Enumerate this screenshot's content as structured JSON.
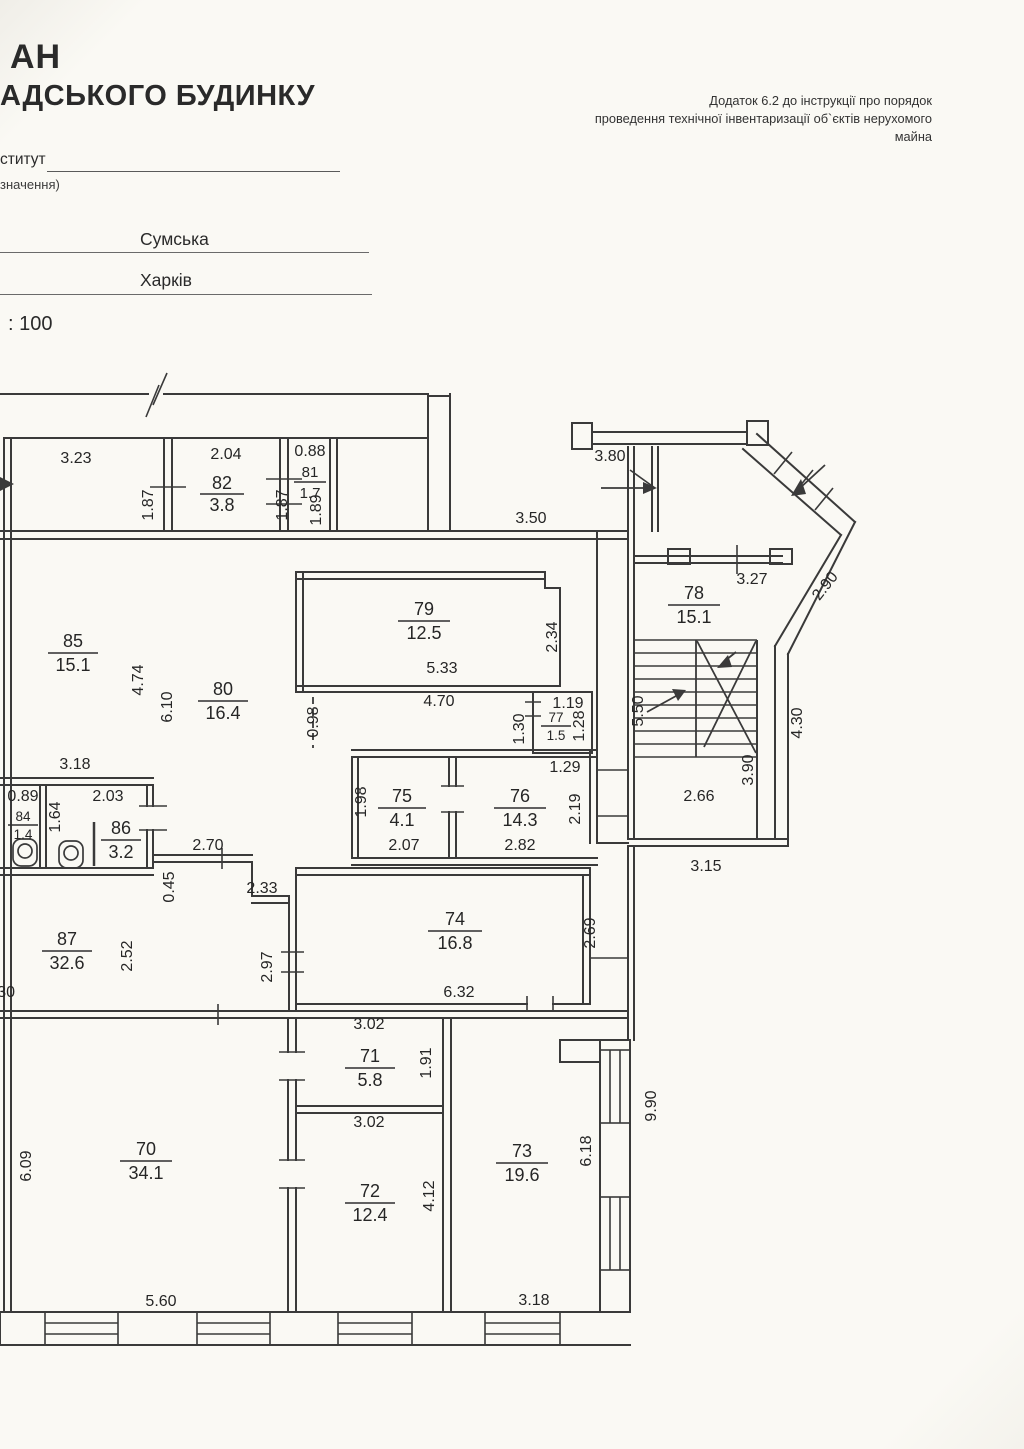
{
  "header": {
    "title_line1": "АН",
    "title_line2": "АДСЬКОГО БУДИНКУ",
    "form_line1": "ститут",
    "form_line2": "значення)",
    "street": "Сумська",
    "city": "Харків",
    "scale": ": 100",
    "annex_line1": "Додаток 6.2 до інструкції про порядок",
    "annex_line2": "проведення технічної інвентаризації об`єктів нерухомого майна"
  },
  "plan": {
    "rooms": [
      {
        "num": "82",
        "area": "3.8"
      },
      {
        "num": "81",
        "area": "1.7"
      },
      {
        "num": "85",
        "area": "15.1"
      },
      {
        "num": "80",
        "area": "16.4"
      },
      {
        "num": "79",
        "area": "12.5"
      },
      {
        "num": "78",
        "area": "15.1"
      },
      {
        "num": "77",
        "area": "1.5"
      },
      {
        "num": "76",
        "area": "14.3"
      },
      {
        "num": "75",
        "area": "4.1"
      },
      {
        "num": "84",
        "area": "1.4"
      },
      {
        "num": "86",
        "area": "3.2"
      },
      {
        "num": "87",
        "area": "32.6"
      },
      {
        "num": "74",
        "area": "16.8"
      },
      {
        "num": "71",
        "area": "5.8"
      },
      {
        "num": "70",
        "area": "34.1"
      },
      {
        "num": "72",
        "area": "12.4"
      },
      {
        "num": "73",
        "area": "19.6"
      }
    ],
    "dims": [
      "3.23",
      "1.87",
      "2.04",
      "1.87",
      "0.88",
      "1.89",
      "3.80",
      "3.50",
      "3.27",
      "2.90",
      "2.34",
      "5.33",
      "4.70",
      "0.98",
      "6.10",
      "4.74",
      "3.18",
      "0.89",
      "2.03",
      "1.64",
      "1.19",
      "1.30",
      "1.28",
      "1.29",
      "1.98",
      "2.07",
      "2.82",
      "2.19",
      "2.70",
      "0.45",
      "2.33",
      "5.50",
      "3.90",
      "2.66",
      "4.30",
      "3.15",
      "2.52",
      "2.97",
      "30",
      "6.32",
      "2.69",
      "3.02",
      "1.91",
      "3.02",
      "6.18",
      "9.90",
      "6.09",
      "5.60",
      "4.12",
      "3.18"
    ]
  }
}
